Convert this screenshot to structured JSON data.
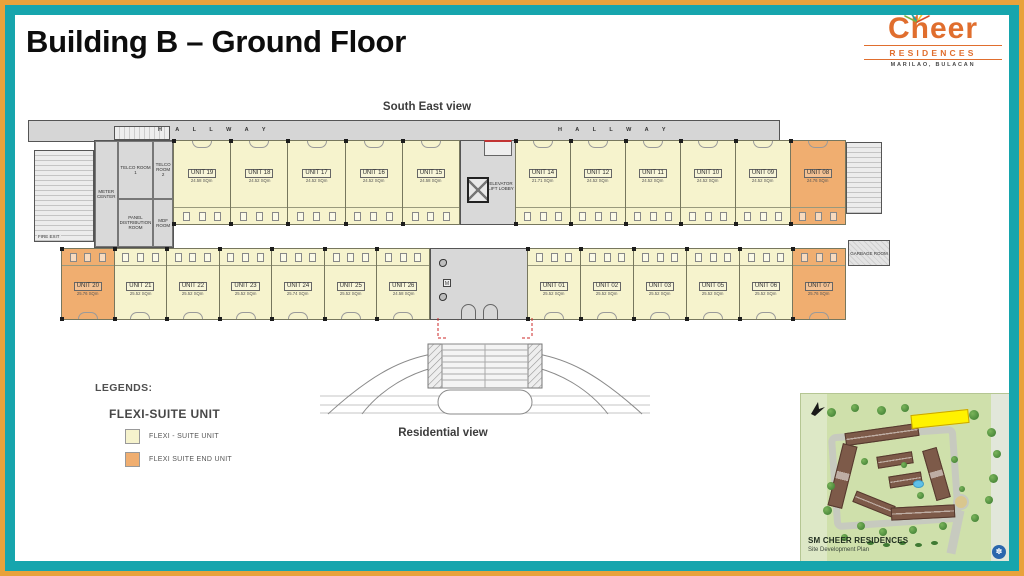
{
  "slide": {
    "title": "Building B – Ground Floor"
  },
  "logo": {
    "brand": "Cheer",
    "residences": "RESIDENCES",
    "location": "MARILAO, BULACAN"
  },
  "plan": {
    "south_label": "South East view",
    "residential_label": "Residential view",
    "hallway_label": "H A L L W A Y",
    "rooms": {
      "meter_center": "METER CENTER",
      "telco1": "TELCO ROOM 1",
      "telco2": "TELCO ROOM 2",
      "panel": "PANEL DISTRIBUTION ROOM",
      "mdf": "MDF ROOM",
      "fire_exit": "FIRE EXIT",
      "elevator": "ELEVATOR LIFT LOBBY",
      "garbage": "GARBAGE ROOM"
    },
    "units": {
      "top_left": [
        {
          "label": "UNIT 19",
          "area": "24.58 SQm",
          "end": false
        },
        {
          "label": "UNIT 18",
          "area": "24.52 SQm",
          "end": false
        },
        {
          "label": "UNIT 17",
          "area": "24.52 SQm",
          "end": false
        },
        {
          "label": "UNIT 16",
          "area": "24.52 SQm",
          "end": false
        },
        {
          "label": "UNIT 15",
          "area": "24.58 SQm",
          "end": false
        }
      ],
      "top_right": [
        {
          "label": "UNIT 14",
          "area": "21.71 SQm",
          "end": false
        },
        {
          "label": "UNIT 12",
          "area": "24.52 SQm",
          "end": false
        },
        {
          "label": "UNIT 11",
          "area": "24.52 SQm",
          "end": false
        },
        {
          "label": "UNIT 10",
          "area": "24.52 SQm",
          "end": false
        },
        {
          "label": "UNIT 09",
          "area": "24.52 SQm",
          "end": false
        },
        {
          "label": "UNIT 08",
          "area": "24.76 SQm",
          "end": true
        }
      ],
      "bottom_left": [
        {
          "label": "UNIT 20",
          "area": "25.76 SQm",
          "end": true
        },
        {
          "label": "UNIT 21",
          "area": "25.52 SQm",
          "end": false
        },
        {
          "label": "UNIT 22",
          "area": "25.52 SQm",
          "end": false
        },
        {
          "label": "UNIT 23",
          "area": "25.52 SQm",
          "end": false
        },
        {
          "label": "UNIT 24",
          "area": "25.74 SQm",
          "end": false
        },
        {
          "label": "UNIT 25",
          "area": "25.52 SQm",
          "end": false
        },
        {
          "label": "UNIT 26",
          "area": "24.58 SQm",
          "end": false
        }
      ],
      "bottom_right": [
        {
          "label": "UNIT 01",
          "area": "25.52 SQm",
          "end": false
        },
        {
          "label": "UNIT 02",
          "area": "25.52 SQm",
          "end": false
        },
        {
          "label": "UNIT 03",
          "area": "25.52 SQm",
          "end": false
        },
        {
          "label": "UNIT 05",
          "area": "25.52 SQm",
          "end": false
        },
        {
          "label": "UNIT 06",
          "area": "25.52 SQm",
          "end": false
        },
        {
          "label": "UNIT 07",
          "area": "25.76 SQm",
          "end": true
        }
      ]
    }
  },
  "legend": {
    "title": "LEGENDS:",
    "subtitle": "FLEXI-SUITE UNIT",
    "items": [
      {
        "label": "FLEXI - SUITE UNIT",
        "color": "#F6F3CD"
      },
      {
        "label": "FLEXI SUITE END UNIT",
        "color": "#F0AE70"
      }
    ]
  },
  "inset": {
    "title": "SM CHEER RESIDENCES",
    "subtitle": "Site Development Plan"
  },
  "colors": {
    "frame_teal": "#16A5AD",
    "frame_orange": "#E8A23B",
    "brand_orange": "#E06E2E",
    "flexi_suite_unit": "#F6F3CD",
    "flexi_suite_end_unit": "#F0AE70",
    "highlight_yellow": "#FFF200"
  }
}
